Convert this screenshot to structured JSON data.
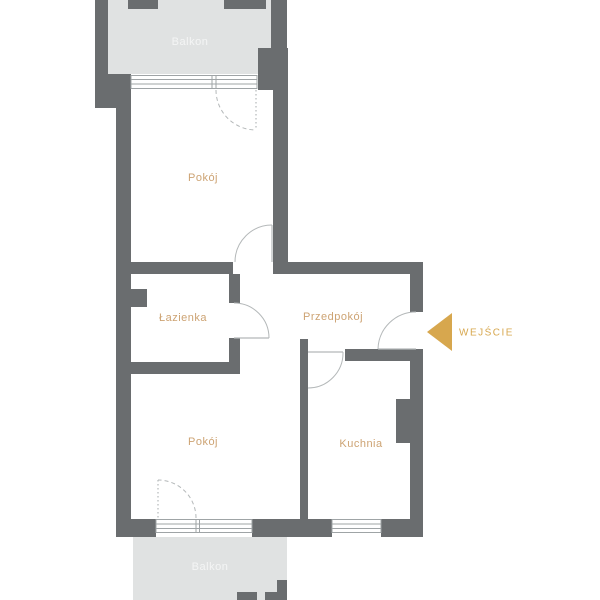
{
  "plan": {
    "rooms": [
      {
        "id": "balkon-top",
        "label": "Balkon"
      },
      {
        "id": "pokoj-top",
        "label": "Pokój"
      },
      {
        "id": "lazienka",
        "label": "Łazienka"
      },
      {
        "id": "przedpokoj",
        "label": "Przedpokój"
      },
      {
        "id": "pokoj-bottom",
        "label": "Pokój"
      },
      {
        "id": "kuchnia",
        "label": "Kuchnia"
      },
      {
        "id": "balkon-bottom",
        "label": "Balkon"
      }
    ],
    "entrance": {
      "label": "WEJŚCIE",
      "arrow_direction": "left"
    },
    "icons": {
      "entrance_arrow": "left-pointing-triangle"
    },
    "colors": {
      "wall": "#6a6d6f",
      "balcony": "#e0e2e2",
      "room_label": "#cda373",
      "balcony_label": "#f4f5f5",
      "accent": "#d7a74e",
      "line": "#9fa4a6",
      "arc": "#b4b8b9",
      "background": "#ffffff"
    }
  }
}
